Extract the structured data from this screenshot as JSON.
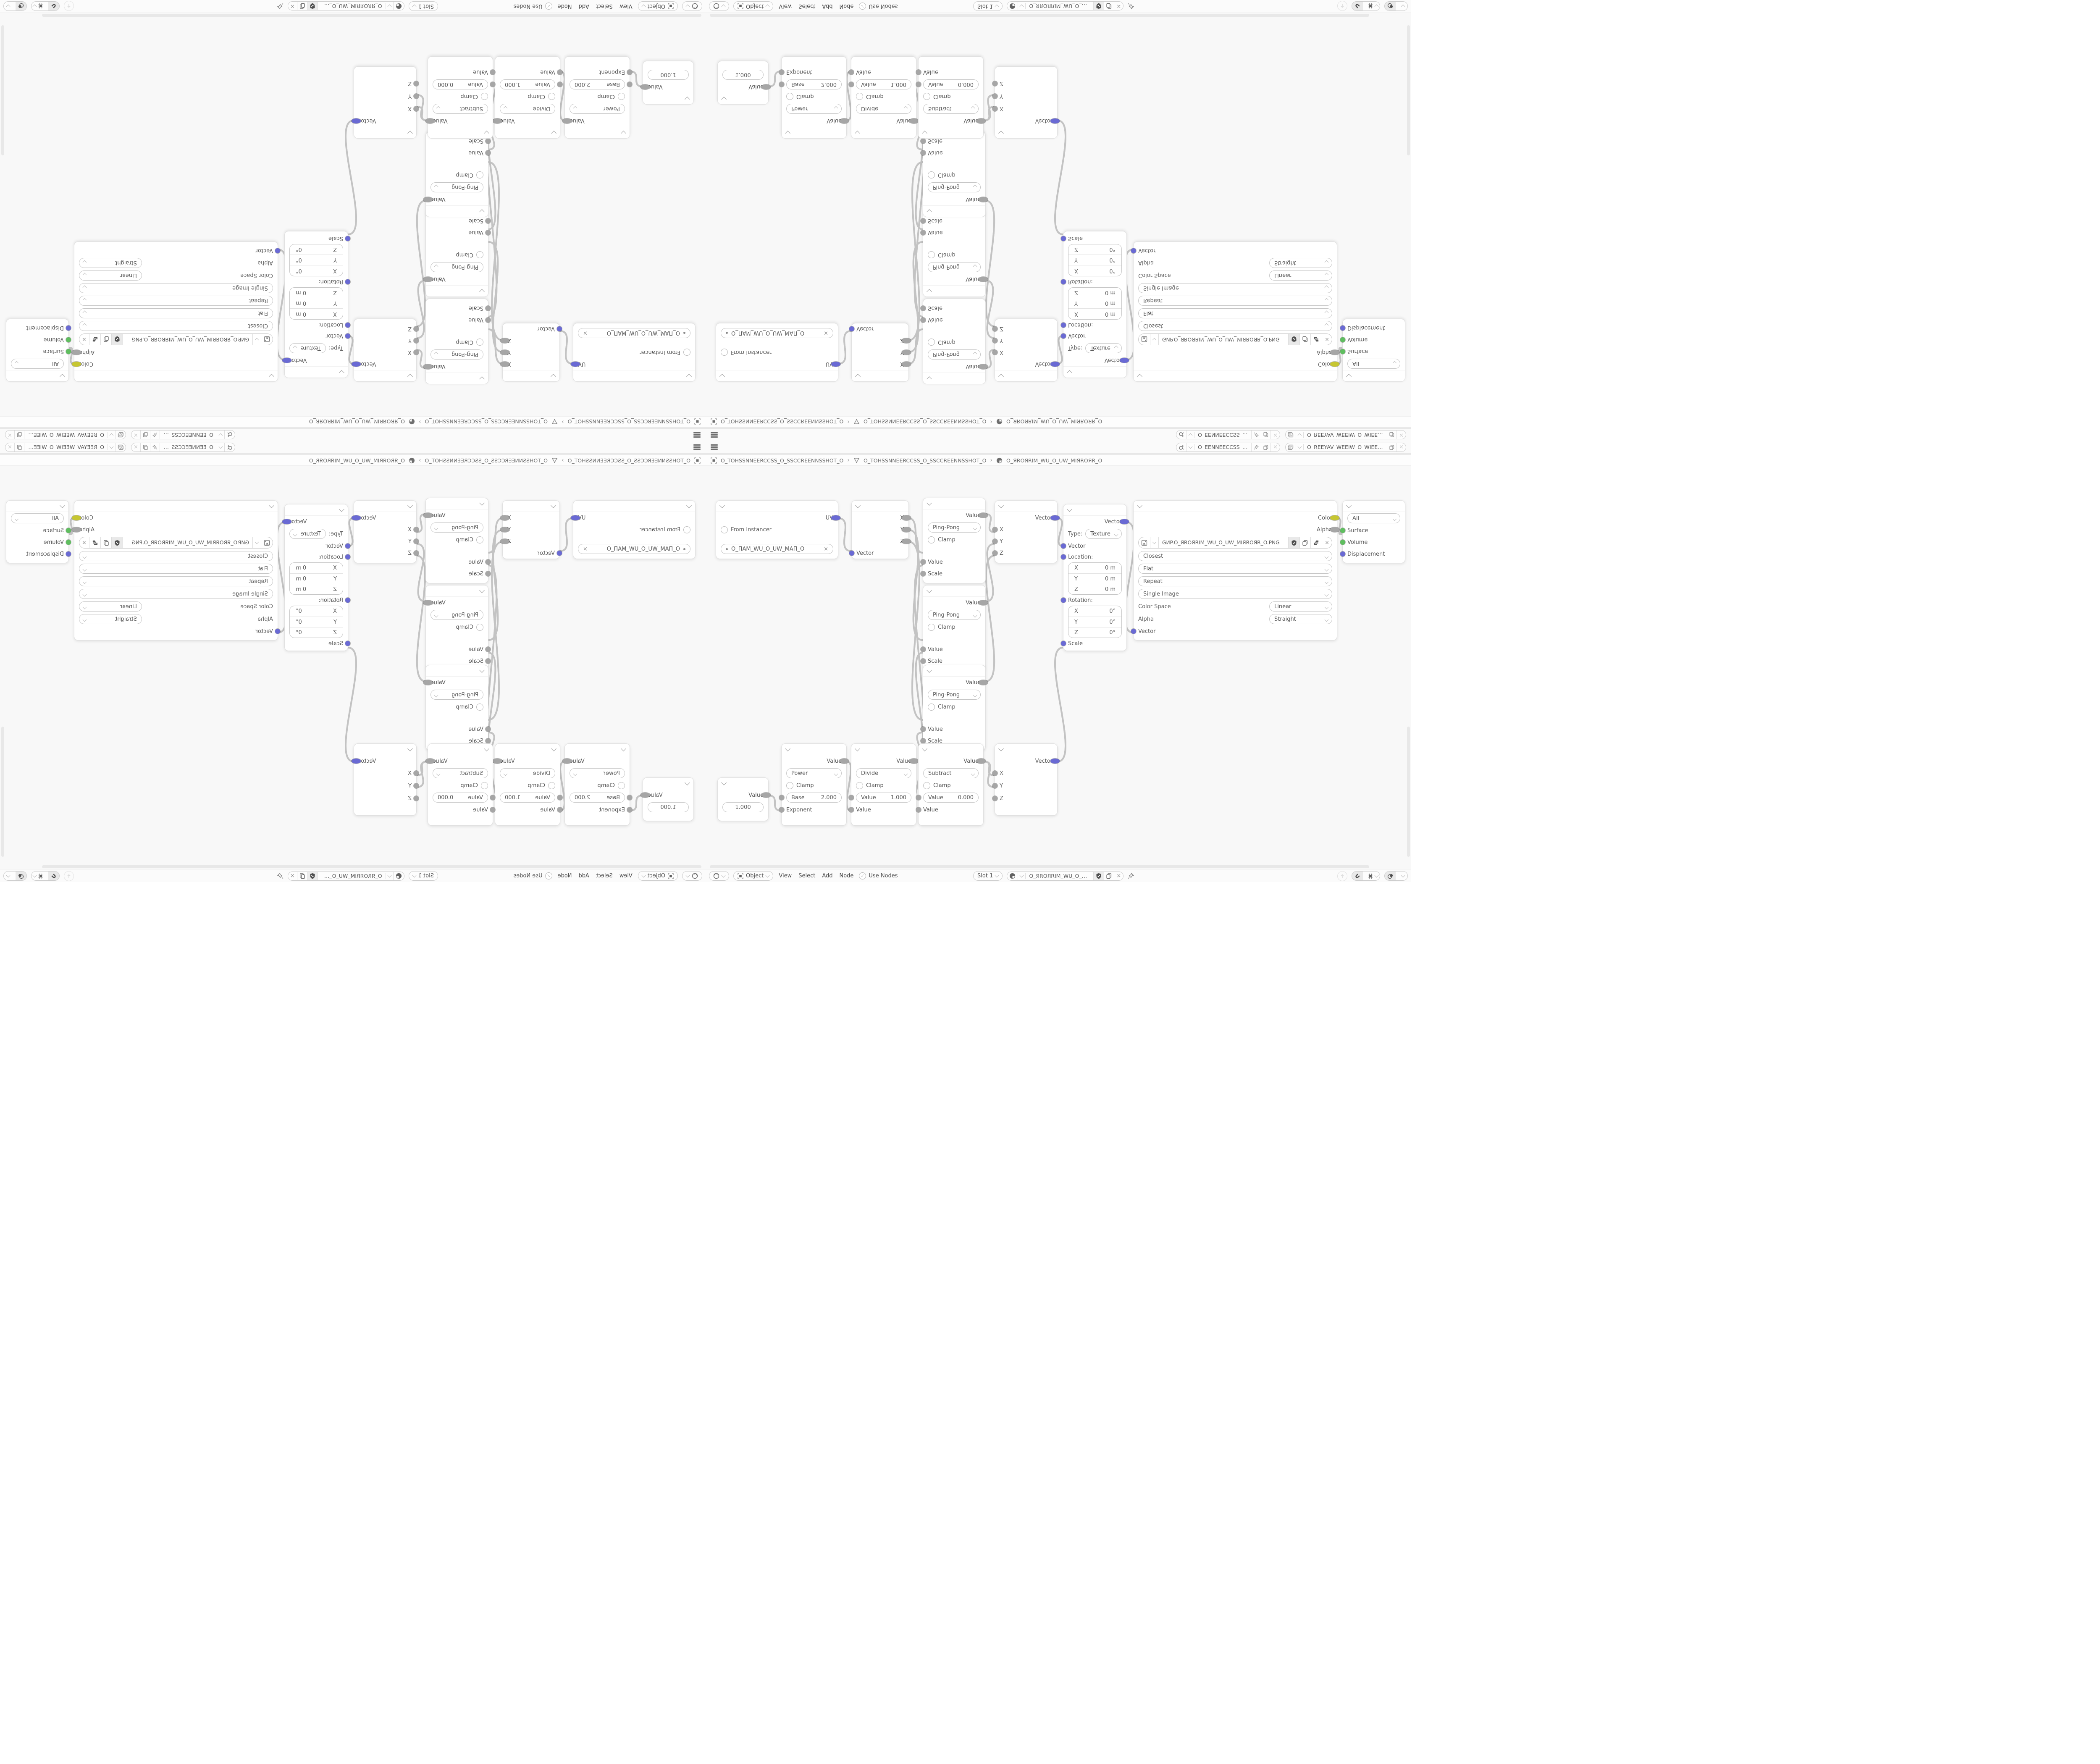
{
  "topbar": {
    "scene_field": {
      "icon": "scene-icon",
      "value": "O_EENNEECCSS_O_SSCCEEN…"
    },
    "view_layer_field": {
      "icon": "view-layer-icon",
      "value": "O_REEYAV_WEEIW_O_WIEEW_VAYEER_O"
    }
  },
  "breadcrumb": {
    "sep": "›",
    "object_name": "O_TOHSSNNEERCCSS_O_SSCCREENNSSHOT_O",
    "mesh_name": "O_TOHSSNNEERCCSS_O_SSCCREENNSSHOT_O",
    "material_name": "O_ЯROЯRIM_WU_O_UW_MIЯROЯR_O"
  },
  "header": {
    "mode": "Object",
    "menu_view": "View",
    "menu_select": "Select",
    "menu_add": "Add",
    "menu_node": "Node",
    "use_nodes": "Use Nodes",
    "slot": "Slot 1",
    "material": "O_ЯROЯRIM_WU_O_UW_MIЯROЯR_O"
  },
  "nodes": {
    "uv_map": {
      "output": "UV",
      "from_instancer": "From Instancer",
      "uv_name": "O_ПAM_WU_O_UW_MAП_O"
    },
    "separate_xyz": {
      "out_x": "X",
      "out_y": "Y",
      "out_z": "Z",
      "input": "Vector"
    },
    "pingpong": {
      "output": "Value",
      "op": "Ping-Pong",
      "clamp": "Clamp",
      "in_value": "Value",
      "in_scale": "Scale"
    },
    "combine_xyz": {
      "output": "Vector",
      "in_x": "X",
      "in_y": "Y",
      "in_z": "Z"
    },
    "mapping": {
      "output": "Vector",
      "type_label": "Type:",
      "type_value": "Texture",
      "input": "Vector",
      "location_label": "Location:",
      "rotation_label": "Rotation:",
      "scale_label": "Scale",
      "loc_x_label": "X",
      "loc_x": "0 m",
      "loc_y_label": "Y",
      "loc_y": "0 m",
      "loc_z_label": "Z",
      "loc_z": "0 m",
      "rot_x_label": "X",
      "rot_x": "0°",
      "rot_y_label": "Y",
      "rot_y": "0°",
      "rot_z_label": "Z",
      "rot_z": "0°"
    },
    "image_texture": {
      "out_color": "Color",
      "out_alpha": "Alpha",
      "filename": "GИP.O_ЯROЯRIM_WU_O_UW_MIЯROЯR_O.PNG",
      "interpolation": "Closest",
      "projection": "Flat",
      "extension": "Repeat",
      "source": "Single Image",
      "color_space_label": "Color Space",
      "color_space": "Linear",
      "alpha_label": "Alpha",
      "alpha_setting": "Straight",
      "input": "Vector"
    },
    "material_output": {
      "target": "All",
      "in_surface": "Surface",
      "in_volume": "Volume",
      "in_displacement": "Displacement"
    },
    "value_node": {
      "output": "Value",
      "value": "1.000"
    },
    "power": {
      "output": "Value",
      "op": "Power",
      "clamp": "Clamp",
      "field_label": "Base",
      "field_value": "2.000",
      "input": "Exponent"
    },
    "divide": {
      "output": "Value",
      "op": "Divide",
      "clamp": "Clamp",
      "field_label": "Value",
      "field_value": "1.000",
      "input": "Value"
    },
    "subtract": {
      "output": "Value",
      "op": "Subtract",
      "clamp": "Clamp",
      "field_label": "Value",
      "field_value": "0.000",
      "input": "Value"
    }
  },
  "icons": {
    "hamburger": "three-bars",
    "scene-icon": "ball-and-cone",
    "view-layer-icon": "stacked-images",
    "pin-icon": "pushpin",
    "copy-icon": "two-pages",
    "close-icon": "×",
    "chevron-down-icon": "v",
    "shield-icon": "shield-with-check",
    "object-icon": "square-with-brackets",
    "mesh-icon": "triangle",
    "material-icon": "half-filled-sphere",
    "image-icon": "picture-frame",
    "shader-ball-icon": "sphere",
    "magnet-icon": "magnet",
    "snap-icon": "grid-cross",
    "overlap-icon": "two-circles",
    "up-arrow-icon": "↑"
  },
  "colors": {
    "socket_vector": "#6a6ad4",
    "socket_value": "#a6a6a6",
    "socket_color": "#c6c632",
    "socket_shader": "#5fbe5f",
    "wire": "#c3c3c3",
    "canvas": "#f8f8f8",
    "node_bg": "#ffffff",
    "bar_bg": "#fafafa"
  }
}
